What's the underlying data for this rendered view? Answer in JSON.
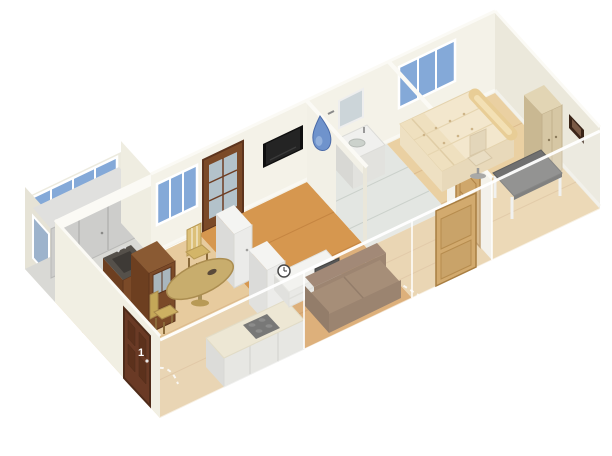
{
  "view": {
    "type": "3d-aerial-floorplan-render",
    "background": "#ffffff",
    "description": "Isometric 3D rendering of an elongated one-bedroom apartment"
  },
  "labels": {
    "entry_door_number": "1"
  },
  "colors": {
    "wall": "#f4f2e8",
    "wallShade": "#eceade",
    "wallDark": "#ebe8db",
    "wallTop": "#fbfaf5",
    "glass": "#84a9d8",
    "tile": "#e3e6e2",
    "floorWood": "#d6974f",
    "laminate": "#e7cb9e",
    "laminateBed": "#ead0a2",
    "doorDark": "#6a3a25",
    "doorMid": "#7b4a28",
    "doorLight": "#cfa76b",
    "woodLight": "#c8ad6d",
    "counter": "#ece4cb",
    "cabinet": "#ebebe9",
    "grayCab": "#cdcdcb",
    "dark": "#4a4a4a",
    "tv": "#0f0f0f",
    "sofa": "#7a5a40",
    "sofaTop": "#8a684c",
    "bed": "#f3e7cd",
    "pillow": "#e8cd96",
    "wardrobe": "#d6c7a4",
    "deskTop": "#707070",
    "accentBlue": "#6f93cc"
  },
  "scene": {
    "rooms": [
      {
        "name": "balcony",
        "furniture": [
          "storage-cabinets",
          "balcony-glazing"
        ]
      },
      {
        "name": "kitchen-dining",
        "furniture": [
          "entry-door",
          "sink-cabinet",
          "china-hutch",
          "round-dining-table",
          "dining-chair",
          "dining-chair",
          "white-counter-run",
          "cooktop",
          "tall-cabinet",
          "tall-cabinet",
          "kitchen-window"
        ]
      },
      {
        "name": "living-room",
        "furniture": [
          "glazed-balcony-door",
          "wall-tv",
          "tv-lowboard",
          "wall-clock",
          "small-tv",
          "sofa"
        ]
      },
      {
        "name": "bathroom",
        "furniture": [
          "vanity-sink",
          "mirror",
          "shower-ornament"
        ]
      },
      {
        "name": "hallway",
        "furniture": [
          "hall-door",
          "front-door"
        ]
      },
      {
        "name": "bedroom",
        "furniture": [
          "double-bed",
          "rolled-pillow",
          "wardrobe",
          "desk",
          "office-chair",
          "picture-frame",
          "bedroom-window"
        ]
      }
    ]
  }
}
